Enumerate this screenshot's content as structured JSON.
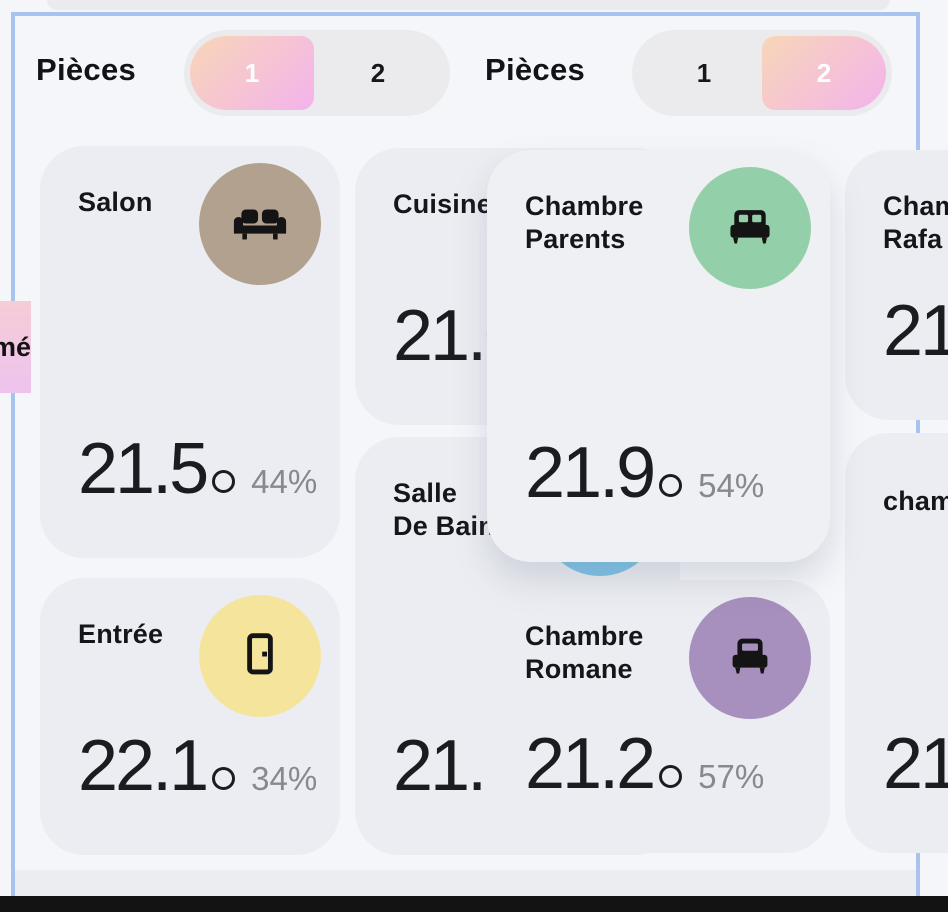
{
  "theme": {
    "page_bg": "#f4f6fa",
    "card_bg": "#ebedf2",
    "floating_card_bg": "#eef0f4",
    "toggle_bg": "#ebebee",
    "frame_blue": "#a9c3ef",
    "accent_gradient_start": "#f8d6b8",
    "accent_gradient_end": "#f3b3ec",
    "pink_chip_start": "#f6ccd6",
    "pink_chip_end": "#eec3ee",
    "temp_color": "#1b1c1f",
    "humidity_color": "#86898f",
    "bottom_bar": "#131313",
    "salon_circle": "#b3a18f",
    "parents_circle": "#93cfa8",
    "entree_circle": "#f5e49c",
    "romane_circle": "#a78fbe",
    "bain_circle": "#7cc3e6"
  },
  "panels": [
    {
      "header": {
        "label": "Pièces",
        "option1": "1",
        "option2": "2",
        "selected": "1"
      },
      "cards": [
        {
          "name": "Salon",
          "temp": "21.5",
          "humidity": "44%",
          "icon": "sofa"
        },
        {
          "name": "Cuisine",
          "temp": "21.0"
        },
        {
          "name": "Salle\nDe Bain",
          "temp": "21.1"
        },
        {
          "name": "Entrée",
          "temp": "22.1",
          "humidity": "34%",
          "icon": "door"
        }
      ]
    },
    {
      "header": {
        "label": "Pièces",
        "option1": "1",
        "option2": "2",
        "selected": "2"
      },
      "cards": [
        {
          "name": "Chambre\nParents",
          "temp": "21.9",
          "humidity": "54%",
          "icon": "bed-double"
        },
        {
          "name": "Chambre\nRafa",
          "temp": "21"
        },
        {
          "name": "chambre",
          "temp": "21"
        },
        {
          "name": "Chambre\nRomane",
          "temp": "21.2",
          "humidity": "57%",
          "icon": "bed-single"
        }
      ]
    }
  ],
  "chip": {
    "label": "mé"
  }
}
